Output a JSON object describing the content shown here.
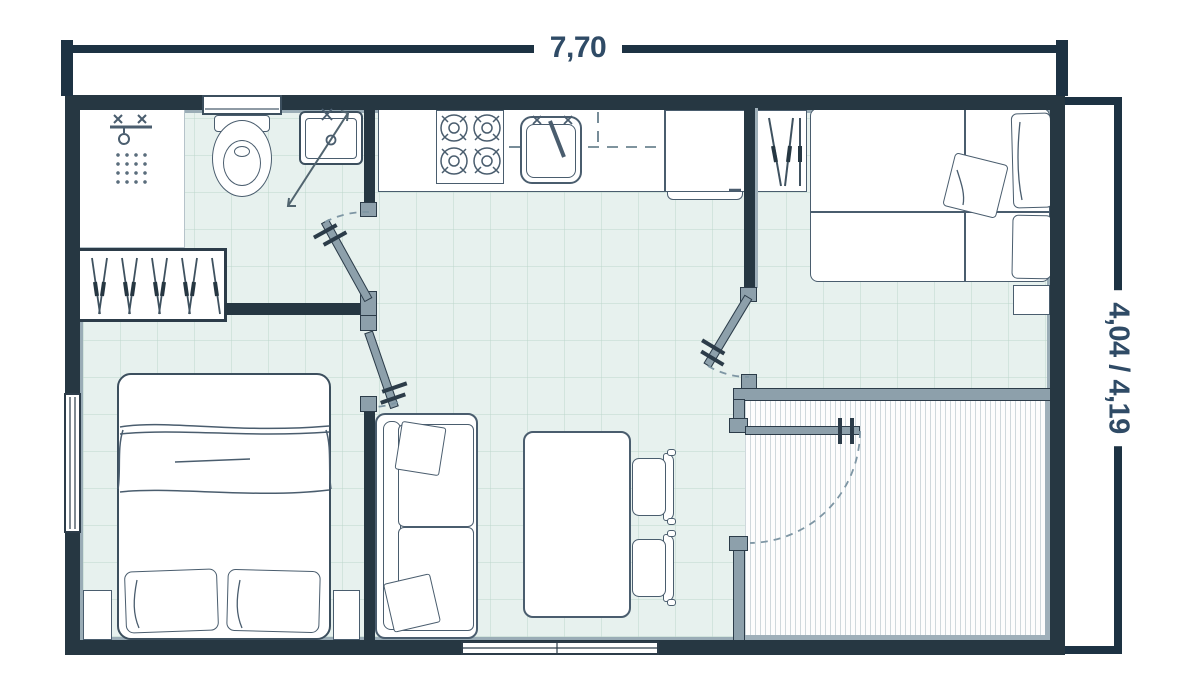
{
  "plan": {
    "type": "mobile-home floor plan drawing",
    "dimensions": {
      "width_label": "7,70",
      "height_label": "4,04 / 4,19"
    },
    "colors": {
      "exterior_wall": "#263742",
      "partition_gray": "#8da0ab",
      "floor_tile": "#e7f1ee",
      "floor_grid": "#b9d4c9",
      "furniture_stroke": "#4a5d6e",
      "dark_stroke": "#2c3c49",
      "dimension_line": "#1d3243",
      "dimension_text": "#2f4b66",
      "door_arc": "#7e96a4",
      "deck_plank": "#cfd8dc"
    },
    "rooms": {
      "bathroom": {
        "items": [
          "shower-tray",
          "shower-fixture",
          "shower-drain",
          "shower-door",
          "toilet",
          "wash-basin"
        ]
      },
      "hallway": {
        "items": [
          "wardrobe-hangers"
        ]
      },
      "kitchen": {
        "items": [
          "counter",
          "stove-4-burners",
          "kitchen-sink",
          "upper-cabinets-dashed",
          "tall-cabinet"
        ]
      },
      "bedroom-double": {
        "items": [
          "double-bed",
          "blanket",
          "pillows",
          "nightstands",
          "window"
        ]
      },
      "bedroom-twin": {
        "items": [
          "wardrobe",
          "twin-beds",
          "pillows",
          "nightstand"
        ]
      },
      "living": {
        "items": [
          "sofa",
          "throw-pillows",
          "dining-table",
          "chairs",
          "sliding-window"
        ]
      },
      "deck": {
        "items": [
          "plank-floor",
          "deck-door"
        ]
      },
      "doors": [
        "bathroom-door",
        "bedroom-double-door",
        "bedroom-twin-door",
        "deck-door"
      ]
    }
  }
}
